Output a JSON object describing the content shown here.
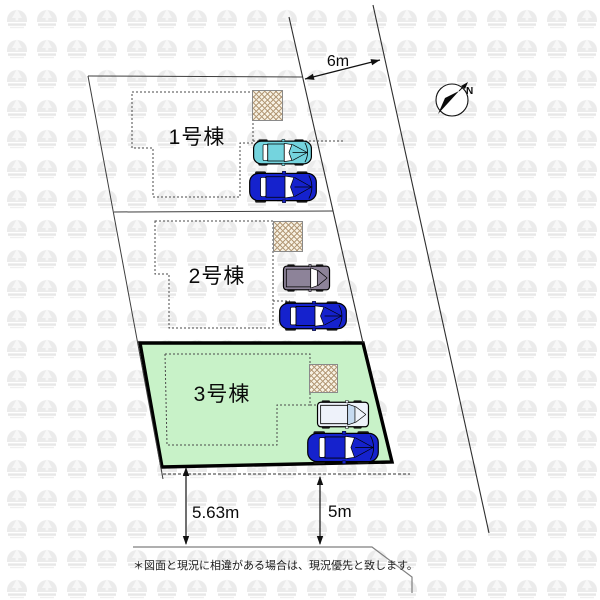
{
  "plan": {
    "road_width_label": "6m",
    "frontage_left_label": "5.63m",
    "frontage_right_label": "5m",
    "compass_label": "N",
    "note": "＊図面と現況に相違がある場合は、現況優先と致します。",
    "lots": [
      {
        "label": "1号棟",
        "highlighted": false
      },
      {
        "label": "2号棟",
        "highlighted": false
      },
      {
        "label": "3号棟",
        "highlighted": true,
        "highlight_color": "#c8f2c8"
      }
    ],
    "cars": [
      {
        "lot": "1号棟",
        "type": "sedan",
        "body_color": "#74d4de",
        "window_color": "#ffffff"
      },
      {
        "lot": "1号棟",
        "type": "sedan",
        "body_color": "#1522cd",
        "window_color": "#ffffff"
      },
      {
        "lot": "2号棟",
        "type": "van",
        "body_color": "#8d8399",
        "window_color": "#ffffff"
      },
      {
        "lot": "2号棟",
        "type": "sedan",
        "body_color": "#1522cd",
        "window_color": "#ffffff"
      },
      {
        "lot": "3号棟",
        "type": "van",
        "body_color": "#eef2fa",
        "window_color": "#c6daf0"
      },
      {
        "lot": "3号棟",
        "type": "sedan",
        "body_color": "#1522cd",
        "window_color": "#ffffff"
      }
    ],
    "hatch_bg": "#f7f1e3",
    "hatch_color": "#b49a78",
    "watermark_color": "#ebebeb"
  }
}
